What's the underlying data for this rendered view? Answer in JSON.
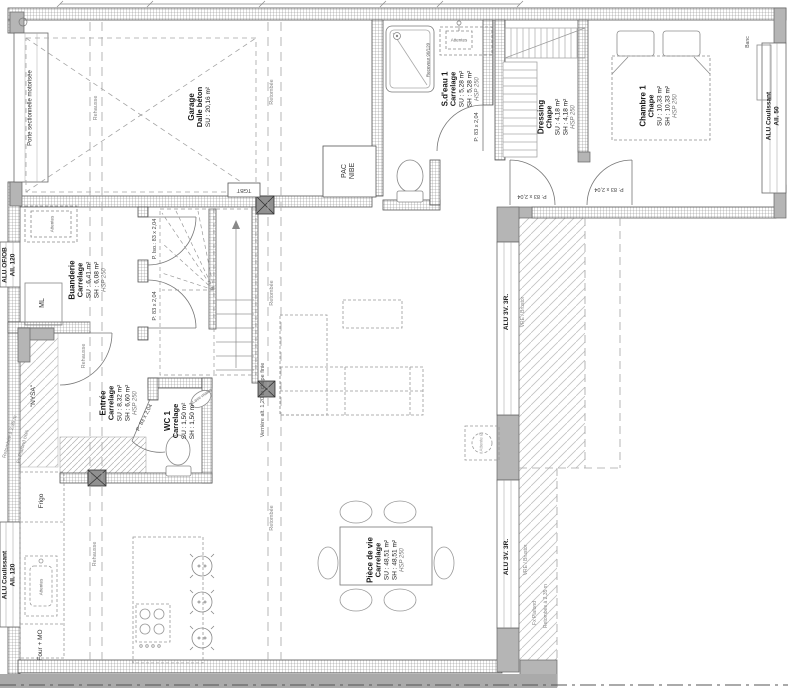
{
  "plan": {
    "rooms": {
      "garage": {
        "name": "Garage",
        "finish": "Dalle béton",
        "su": "SU : 20,16 m²"
      },
      "sdeau1": {
        "name": "S.d'eau 1",
        "finish": "Carrelage",
        "su": "SU : 5,28 m²",
        "sh": "SH : 5,28 m²",
        "hsp": "HSP 250"
      },
      "dressing": {
        "name": "Dressing",
        "finish": "Chape",
        "su": "SU : 4,18 m²",
        "sh": "SH : 4,18 m²",
        "hsp": "HSP 250"
      },
      "chambre1": {
        "name": "Chambre 1",
        "finish": "Chape",
        "su": "SU : 10,33 m²",
        "sh": "SH : 10,33 m²",
        "hsp": "HSP 250"
      },
      "buanderie": {
        "name": "Buanderie",
        "finish": "Carrelage",
        "su": "SU : 6,41 m²",
        "sh": "SH : 6,08 m²",
        "hsp": "HSP 250"
      },
      "entree": {
        "name": "Entrée",
        "finish": "Carrelage",
        "su": "SU : 8,32 m²",
        "sh": "SH : 6,60 m²",
        "hsp": "HSP 250"
      },
      "wc1": {
        "name": "WC 1",
        "finish": "Carrelage",
        "su": "SU : 1,50 m²",
        "sh": "SH : 1,50 m²"
      },
      "piece_de_vie": {
        "name": "Pièce de vie",
        "finish": "Carrelage",
        "su": "SU : 48,51 m²",
        "sh": "SH : 48,51 m²",
        "hsp": "HSP 250"
      }
    },
    "openings": {
      "porte_garage": "Porte sectionnelle motorisée",
      "alu_ofob": "ALU OF/OB",
      "alu_coulissant": "ALU Coulissant",
      "allege_120": "All. 120",
      "allege_50": "All. 50",
      "alu_3v3r": "ALU 3V. 3R.",
      "vre": "VRE / Brustor",
      "porte_iso": "P. Iso.: 83 x 2,04",
      "porte_83": "P: 83 x 2,04"
    },
    "equipment": {
      "pac_l1": "PAC",
      "pac_l2": "NIBE",
      "tgbt": "TGBT",
      "ml": "ML",
      "frigo": "Frigo",
      "four_mo": "Four + MO",
      "attentes": "Attentes",
      "nysa": "\"NYSA\"",
      "receveur": "Receveur 90/120",
      "lave_mains": "Lave-mains",
      "banc": "Banc",
      "attente_o": "Attente Ø"
    },
    "annotations": {
      "rehausse": "Rehausse",
      "retombee": "Retombée",
      "retombee_235": "Retombée à 2,35 m",
      "fx_plafond_bois": "Fx Plafond bois",
      "fx_plafond": "Fx Plafond",
      "verriere": "Verrière alt. 1,20 m chape finie"
    },
    "colors": {
      "wall_line": "#555555",
      "poche": "#b5b5b5",
      "furniture": "#8c8c8c"
    }
  }
}
